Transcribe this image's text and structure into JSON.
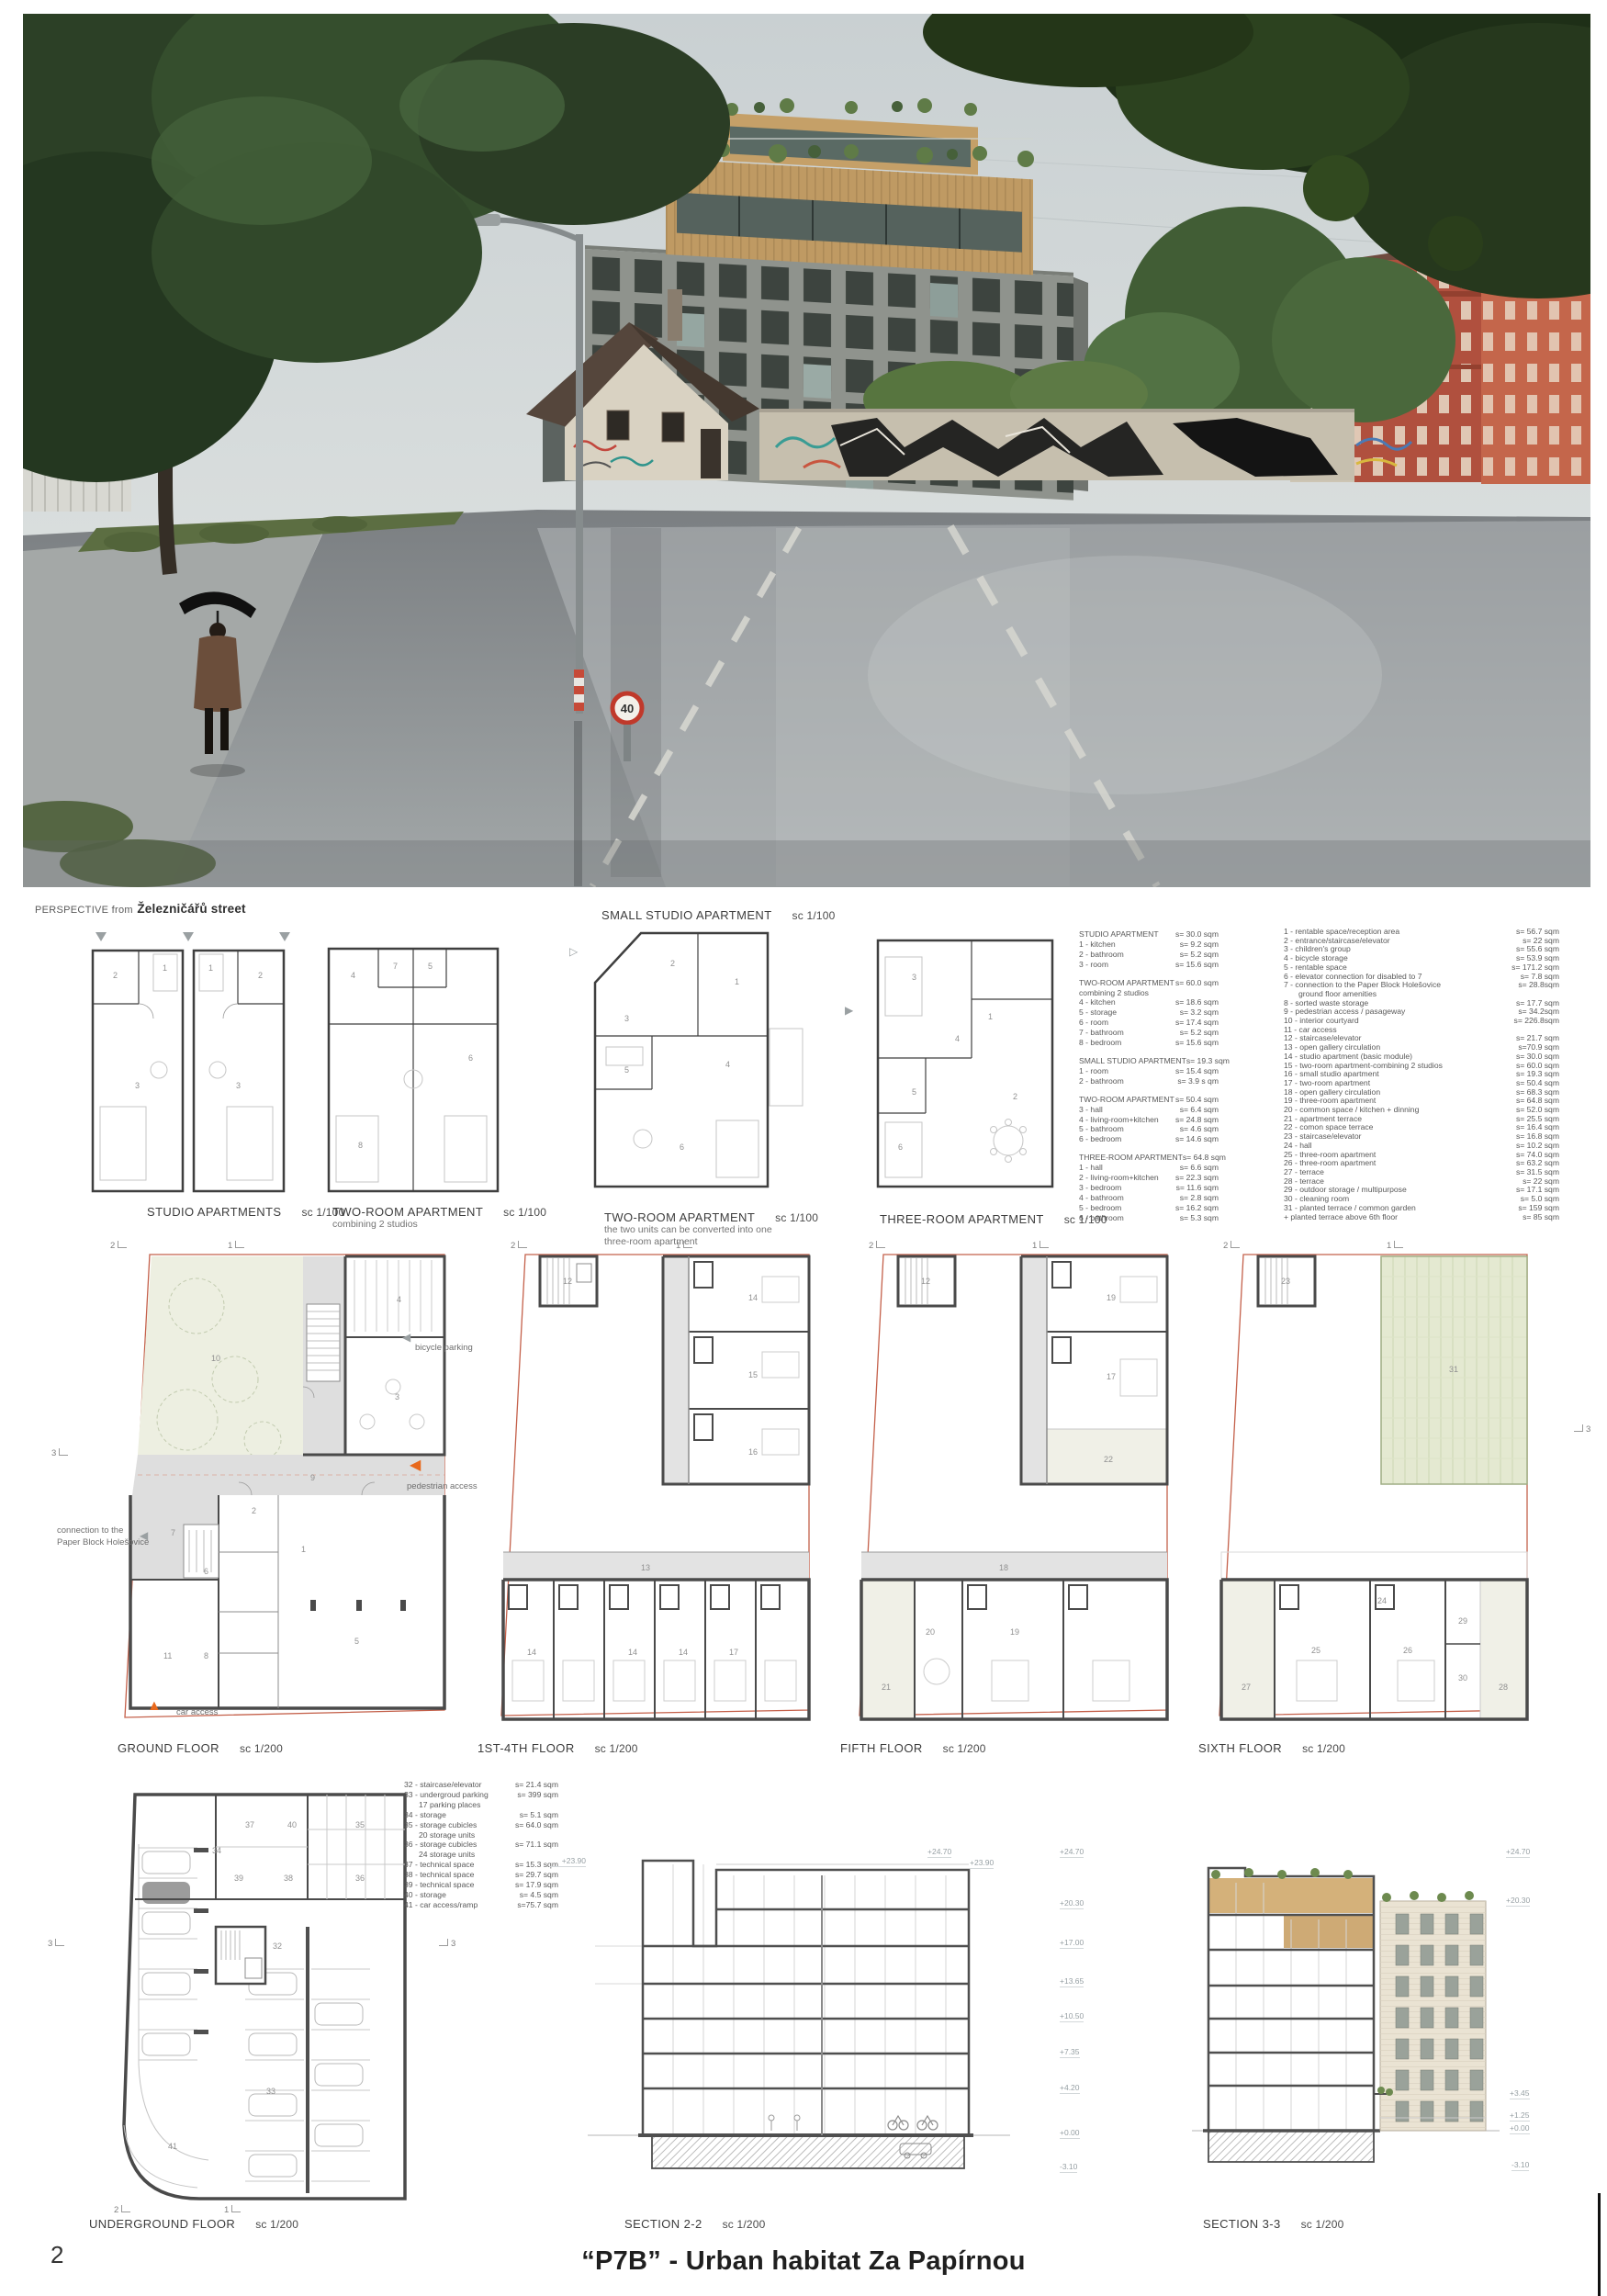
{
  "footer": {
    "page_number": "2",
    "title": "“P7B” - Urban habitat Za Papírnou"
  },
  "photo": {
    "caption_prefix": "PERSPECTIVE from",
    "caption_street": "Železničářů street",
    "speed_sign": "40"
  },
  "headers": {
    "small_studio_label": "SMALL STUDIO APARTMENT",
    "small_studio_scale": "sc 1/100"
  },
  "apartment_plans": {
    "studios": {
      "label": "STUDIO APARTMENTS",
      "scale": "sc 1/100"
    },
    "two_room_a": {
      "label": "TWO-ROOM APARTMENT",
      "scale": "sc 1/100",
      "note": "combining 2 studios"
    },
    "two_room_b": {
      "label": "TWO-ROOM APARTMENT",
      "scale": "sc 1/100",
      "note1": "the two units can be converted into one",
      "note2": "three-room apartment"
    },
    "three_room": {
      "label": "THREE-ROOM APARTMENT",
      "scale": "sc 1/100"
    }
  },
  "legend_apartments": {
    "groups": [
      {
        "title": "STUDIO APARTMENT",
        "area": "s= 30.0 sqm",
        "note": "",
        "items": [
          {
            "label": "1 - kitchen",
            "area": "s= 9.2 sqm"
          },
          {
            "label": "2 - bathroom",
            "area": "s= 5.2 sqm"
          },
          {
            "label": "3 - room",
            "area": "s= 15.6 sqm"
          }
        ]
      },
      {
        "title": "TWO-ROOM APARTMENT",
        "area": "s= 60.0 sqm",
        "note": "combining 2 studios",
        "items": [
          {
            "label": "4 - kitchen",
            "area": "s= 18.6 sqm"
          },
          {
            "label": "5 - storage",
            "area": "s= 3.2 sqm"
          },
          {
            "label": "6 - room",
            "area": "s= 17.4 sqm"
          },
          {
            "label": "7 - bathroom",
            "area": "s= 5.2 sqm"
          },
          {
            "label": "8 - bedroom",
            "area": "s= 15.6 sqm"
          }
        ]
      },
      {
        "title": "SMALL STUDIO APARTMENT",
        "area": "s= 19.3 sqm",
        "note": "",
        "items": [
          {
            "label": "1 - room",
            "area": "s= 15.4 sqm"
          },
          {
            "label": "2 - bathroom",
            "area": "s= 3.9 s qm"
          }
        ]
      },
      {
        "title": "TWO-ROOM APARTMENT",
        "area": "s= 50.4 sqm",
        "note": "",
        "items": [
          {
            "label": "3 - hall",
            "area": "s= 6.4 sqm"
          },
          {
            "label": "4 - living-room+kitchen",
            "area": "s= 24.8 sqm"
          },
          {
            "label": "5 - bathroom",
            "area": "s= 4.6 sqm"
          },
          {
            "label": "6 - bedroom",
            "area": "s= 14.6 sqm"
          }
        ]
      },
      {
        "title": "THREE-ROOM APARTMENT",
        "area": "s= 64.8 sqm",
        "note": "",
        "items": [
          {
            "label": "1 - hall",
            "area": "s= 6.6 sqm"
          },
          {
            "label": "2 - living-room+kitchen",
            "area": "s= 22.3 sqm"
          },
          {
            "label": "3 - bedroom",
            "area": "s= 11.6 sqm"
          },
          {
            "label": "4 - bathroom",
            "area": "s= 2.8 sqm"
          },
          {
            "label": "5 - bedroom",
            "area": "s= 16.2 sqm"
          },
          {
            "label": "6 - bathroom",
            "area": "s= 5.3 sqm"
          }
        ]
      }
    ]
  },
  "legend_building": {
    "items": [
      {
        "label": "1  - rentable space/reception area",
        "area": "s= 56.7 sqm",
        "sub": ""
      },
      {
        "label": "2  - entrance/staircase/elevator",
        "area": "s= 22 sqm",
        "sub": ""
      },
      {
        "label": "3  - children's group",
        "area": "s= 55.6 sqm",
        "sub": ""
      },
      {
        "label": "4  - bicycle storage",
        "area": "s= 53.9 sqm",
        "sub": ""
      },
      {
        "label": "5  - rentable space",
        "area": "s= 171.2 sqm",
        "sub": ""
      },
      {
        "label": "6  - elevator connection for disabled to 7",
        "area": "s= 7.8 sqm",
        "sub": ""
      },
      {
        "label": "7  - connection to the Paper Block Holešovice",
        "area": "s= 28.8sqm",
        "sub": "ground floor amenities"
      },
      {
        "label": "8  - sorted waste storage",
        "area": "s= 17.7 sqm",
        "sub": ""
      },
      {
        "label": "9  - pedestrian access / pasageway",
        "area": "s= 34.2sqm",
        "sub": ""
      },
      {
        "label": "10 - interior courtyard",
        "area": "s= 226.8sqm",
        "sub": ""
      },
      {
        "label": "11 - car access",
        "area": "",
        "sub": ""
      },
      {
        "label": "12 - staircase/elevator",
        "area": "s= 21.7 sqm",
        "sub": ""
      },
      {
        "label": "13 - open gallery circulation",
        "area": "s=70.9 sqm",
        "sub": ""
      },
      {
        "label": "14 - studio apartment (basic module)",
        "area": "s= 30.0 sqm",
        "sub": ""
      },
      {
        "label": "15 - two-room apartment-combining 2 studios",
        "area": "s= 60.0 sqm",
        "sub": ""
      },
      {
        "label": "16 - small studio apartment",
        "area": "s= 19.3 sqm",
        "sub": ""
      },
      {
        "label": "17 - two-room apartment",
        "area": "s= 50.4 sqm",
        "sub": ""
      },
      {
        "label": "18 - open gallery circulation",
        "area": "s= 68.3 sqm",
        "sub": ""
      },
      {
        "label": "19 - three-room apartment",
        "area": "s= 64.8 sqm",
        "sub": ""
      },
      {
        "label": "20 - common space / kitchen + dinning",
        "area": "s= 52.0 sqm",
        "sub": ""
      },
      {
        "label": "21 - apartment terrace",
        "area": "s= 25.5 sqm",
        "sub": ""
      },
      {
        "label": "22 - comon space terrace",
        "area": "s= 16.4 sqm",
        "sub": ""
      },
      {
        "label": "23 - staircase/elevator",
        "area": "s= 16.8 sqm",
        "sub": ""
      },
      {
        "label": "24 - hall",
        "area": "s= 10.2 sqm",
        "sub": ""
      },
      {
        "label": "25 - three-room apartment",
        "area": "s= 74.0 sqm",
        "sub": ""
      },
      {
        "label": "26 - three-room apartment",
        "area": "s= 63.2 sqm",
        "sub": ""
      },
      {
        "label": "27 - terrace",
        "area": "s= 31.5 sqm",
        "sub": ""
      },
      {
        "label": "28 - terrace",
        "area": "s= 22 sqm",
        "sub": ""
      },
      {
        "label": "29 - outdoor storage / multipurpose",
        "area": "s= 17.1 sqm",
        "sub": ""
      },
      {
        "label": "30 - cleaning room",
        "area": "s= 5.0 sqm",
        "sub": ""
      },
      {
        "label": "31 - planted terrace / common garden",
        "area": "s= 159 sqm",
        "sub": ""
      },
      {
        "label": "+ planted terrace above 6th floor",
        "area": "s= 85 sqm",
        "sub": ""
      }
    ]
  },
  "floor_plans": {
    "ground": {
      "label": "GROUND FLOOR",
      "scale": "sc 1/200"
    },
    "floors14": {
      "label": "1ST-4TH FLOOR",
      "scale": "sc 1/200"
    },
    "fifth": {
      "label": "FIFTH FLOOR",
      "scale": "sc 1/200"
    },
    "sixth": {
      "label": "SIXTH FLOOR",
      "scale": "sc 1/200"
    }
  },
  "annotations": {
    "bicycle_parking": "bicycle parking",
    "pedestrian_access": "pedestrian access",
    "connection_line1": "connection to the",
    "connection_line2": "Paper Block Holešovice",
    "car_access": "car access"
  },
  "marks": {
    "m1": "1",
    "m2": "2",
    "m3": "3"
  },
  "underground": {
    "label": "UNDERGROUND FLOOR",
    "scale": "sc 1/200",
    "legend": [
      {
        "label": "32 - staircase/elevator",
        "area": "s= 21.4 sqm",
        "sub": ""
      },
      {
        "label": "33 - undergroud parking",
        "area": "s= 399 sqm",
        "sub": "17 parking places"
      },
      {
        "label": "34 - storage",
        "area": "s= 5.1 sqm",
        "sub": ""
      },
      {
        "label": "35 - storage cubicles",
        "area": "s= 64.0 sqm",
        "sub": "20 storage units"
      },
      {
        "label": "36 - storage cubicles",
        "area": "s= 71.1 sqm",
        "sub": "24 storage units"
      },
      {
        "label": "37 - technical space",
        "area": "s= 15.3 sqm",
        "sub": ""
      },
      {
        "label": "38 - technical space",
        "area": "s= 29.7 sqm",
        "sub": ""
      },
      {
        "label": "39 - technical space",
        "area": "s= 17.9 sqm",
        "sub": ""
      },
      {
        "label": "40 - storage",
        "area": "s= 4.5 sqm",
        "sub": ""
      },
      {
        "label": "41 - car access/ramp",
        "area": "s=75.7 sqm",
        "sub": ""
      }
    ]
  },
  "sections": {
    "s22": {
      "label": "SECTION 2-2",
      "scale": "sc 1/200",
      "left_level": "+23.90",
      "top_levels": [
        "+24.70",
        "+23.90"
      ],
      "right_levels": [
        "+24.70",
        "+20.30",
        "+17.00",
        "+13.65",
        "+10.50",
        "+7.35",
        "+4.20",
        "+0.00",
        "-3.10"
      ]
    },
    "s33": {
      "label": "SECTION 3-3",
      "scale": "sc 1/200",
      "right_levels": [
        "+24.70",
        "+20.30",
        "+3.45",
        "+1.25",
        "+0.00",
        "-3.10"
      ]
    }
  },
  "rooms": {
    "studio": [
      "1",
      "2",
      "3",
      "1",
      "2",
      "3"
    ],
    "two_a": [
      "4",
      "5",
      "6",
      "7",
      "8"
    ],
    "two_b": [
      "1",
      "2",
      "3",
      "4",
      "5",
      "6"
    ],
    "three": [
      "1",
      "2",
      "3",
      "4",
      "5",
      "6"
    ],
    "ground": [
      "10",
      "4",
      "3",
      "9",
      "2",
      "7",
      "6",
      "8",
      "11",
      "5",
      "1"
    ],
    "floors14": [
      "12",
      "14",
      "15",
      "16",
      "13",
      "14",
      "14",
      "17",
      "14"
    ],
    "fifth": [
      "12",
      "19",
      "17",
      "22",
      "18",
      "20",
      "19",
      "21"
    ],
    "sixth": [
      "23",
      "31",
      "24",
      "25",
      "26",
      "27",
      "28",
      "29",
      "30"
    ],
    "under": [
      "35",
      "36",
      "37",
      "39",
      "40",
      "38",
      "32",
      "33",
      "41",
      "34"
    ]
  }
}
